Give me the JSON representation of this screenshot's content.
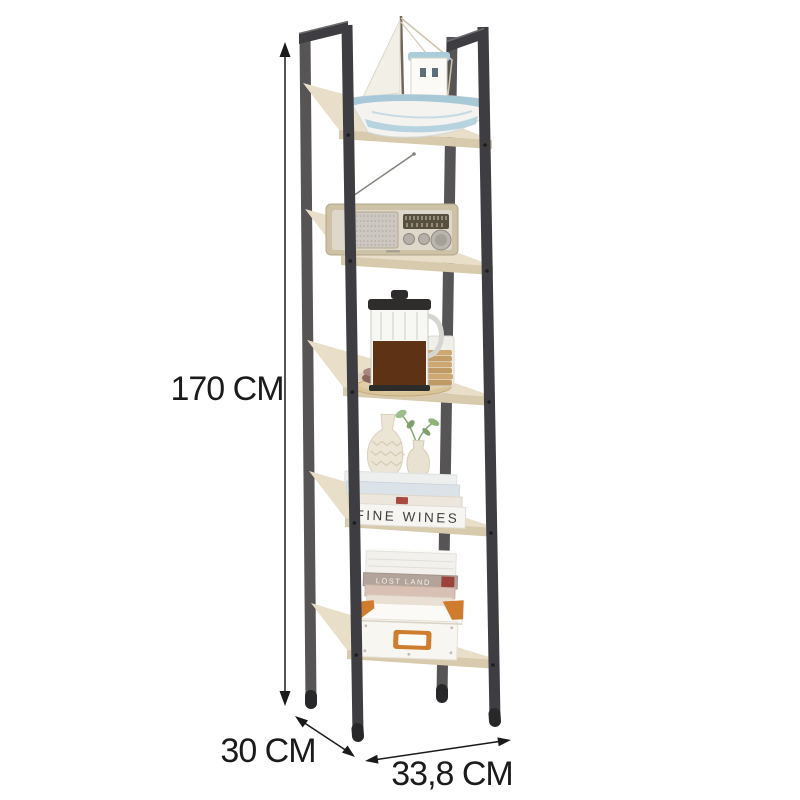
{
  "page": {
    "background": "#ffffff",
    "type": "product-dimension-image"
  },
  "product": {
    "name": "5-tier ladder bookshelf",
    "shelf_count": "5",
    "frame_color": "#3e3e42",
    "frame_rear_color": "#4e4b4c",
    "frame_cap_color": "#28282a",
    "wood_color": "#e9dfc8",
    "wood_edge_color": "#d8caac",
    "accent_orange": "#cf7c2e"
  },
  "annotations": {
    "height_label": "170 CM",
    "depth_label": "30 CM",
    "width_label": "33,8 CM",
    "line_color": "#1a1a1a"
  },
  "decor": {
    "shelf1": "sailboat-model",
    "shelf2": "vintage-radio",
    "shelf3": "french-press-coffee-set",
    "shelf4": "vases-and-books",
    "shelf5": "books-and-storage-box",
    "fine_wines_text": "FINE WINES",
    "lost_land_text": "LOST LAND"
  }
}
